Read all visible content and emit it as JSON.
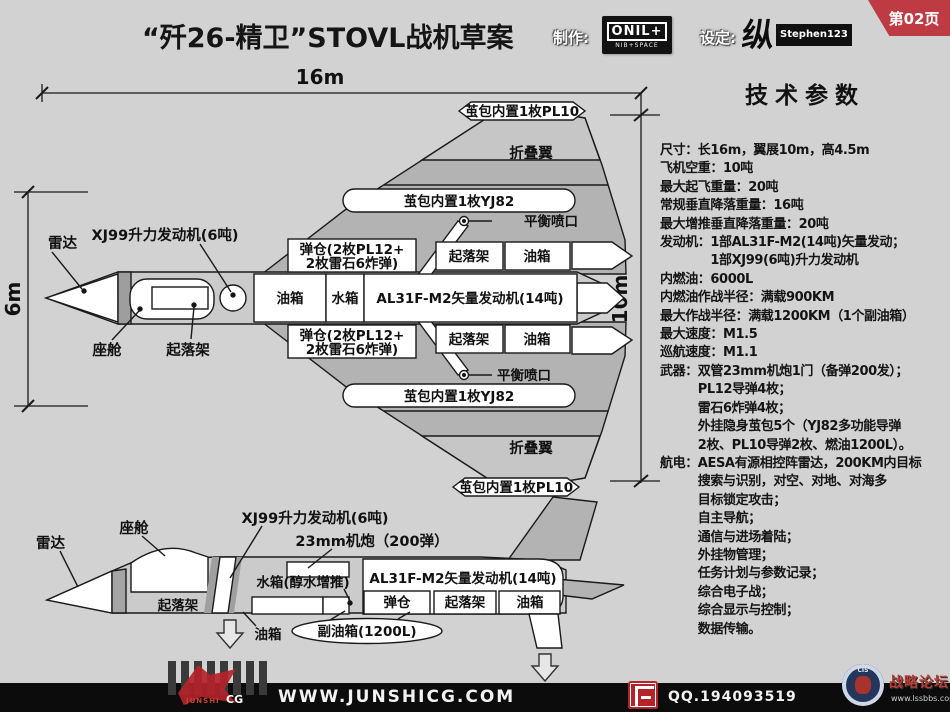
{
  "header": {
    "title": "“歼26-精卫”STOVL战机草案",
    "maker_label": "制作:",
    "maker_logo_main": "ONIL+",
    "maker_logo_sub": "NIB+SPACE",
    "designer_label": "设定:",
    "designer_glyph": "纵",
    "designer_name": "Stephen123",
    "page_badge": "第02页",
    "accent_red": "#bf3b44"
  },
  "specs": {
    "heading": "技术参数",
    "lines": [
      "尺寸：长16m，翼展10m，高4.5m",
      "飞机空重：10吨",
      "最大起飞重量：20吨",
      "常规垂直降落重量：16吨",
      "最大增推垂直降落重量：20吨",
      "发动机：1部AL31F-M2(14吨)矢量发动；",
      "　　　　1部XJ99(6吨)升力发动机",
      "内燃油：6000L",
      "内燃油作战半径：满载900KM",
      "最大作战半径：满载1200KM（1个副油箱）",
      "最大速度：M1.5",
      "巡航速度：M1.1",
      "武器：双管23mm机炮1门（备弹200发）；",
      "　　　PL12导弹4枚；",
      "　　　雷石6炸弹4枚；",
      "　　　外挂隐身茧包5个（YJ82多功能导弹",
      "　　　2枚、PL10导弹2枚、燃油1200L）。",
      "航电：AESA有源相控阵雷达，200KM内目标",
      "　　　搜索与识别，对空、对地、对海多",
      "　　　目标锁定攻击；",
      "　　　自主导航；",
      "　　　通信与进场着陆；",
      "　　　外挂物管理；",
      "　　　任务计划与参数记录；",
      "　　　综合电子战；",
      "　　　综合显示与控制；",
      "　　　数据传输。"
    ]
  },
  "diagram": {
    "dims": {
      "length": "16m",
      "height": "6m",
      "span": "10m"
    },
    "labels": {
      "radar": "雷达",
      "cockpit": "座舱",
      "gear": "起落架",
      "fuel": "油箱",
      "water": "水箱",
      "lift_engine": "XJ99升力发动机(6吨)",
      "main_engine": "AL31F-M2矢量发动机(14吨)",
      "bay_line1": "弹仓(2枚PL12+",
      "bay_line2": "2枚雷石6炸弹)",
      "bay_short": "弹仓",
      "pod_pl10": "茧包内置1枚PL10",
      "pod_yj82": "茧包内置1枚YJ82",
      "fold_wing": "折叠翼",
      "balance_nozzle": "平衡喷口",
      "gun": "23mm机炮（200弹）",
      "water_boost": "水箱(醇水增推)",
      "drop_tank": "副油箱(1200L)"
    }
  },
  "footer": {
    "site": "WWW.JUNSHICG.COM",
    "qq": "QQ.194093519",
    "logo_cg": "CG",
    "logo_junshi": "JUNSHI",
    "forum_name": "战略论坛",
    "forum_url": "www.lssbbs.com",
    "emblem_text": "CIS"
  }
}
